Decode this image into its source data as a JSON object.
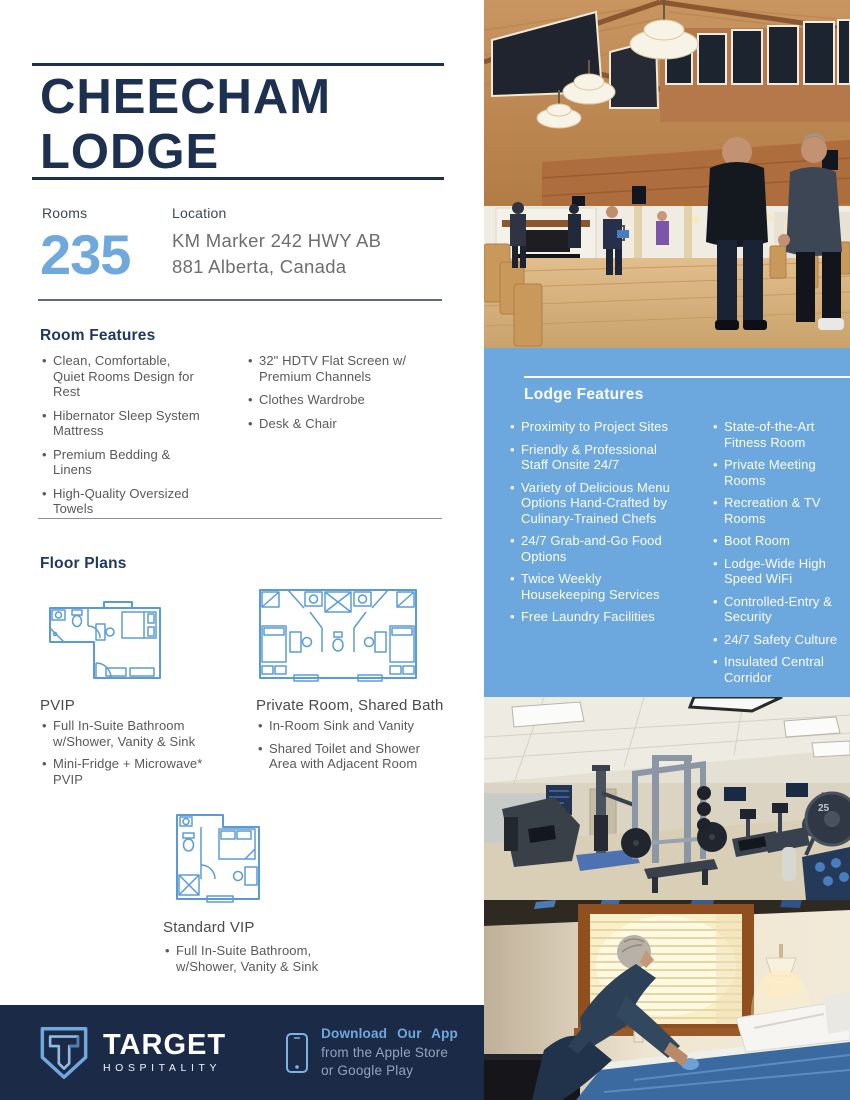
{
  "header": {
    "title_line1": "CHEECHAM",
    "title_line2": "LODGE"
  },
  "stats": {
    "rooms_label": "Rooms",
    "rooms_value": "235",
    "location_label": "Location",
    "location_line1": "KM Marker 242 HWY AB",
    "location_line2": "881 Alberta, Canada"
  },
  "room_features": {
    "heading": "Room Features",
    "col1": [
      "Clean, Comfortable, Quiet Rooms Design for Rest",
      "Hibernator Sleep System Mattress",
      "Premium Bedding & Linens",
      "High-Quality Oversized Towels"
    ],
    "col2": [
      "32\" HDTV Flat Screen w/ Premium Channels",
      "Clothes Wardrobe",
      "Desk & Chair"
    ]
  },
  "lodge_features": {
    "heading": "Lodge Features",
    "col1": [
      "Proximity to Project Sites",
      "Friendly & Professional Staff Onsite 24/7",
      "Variety of Delicious Menu Options Hand-Crafted by Culinary-Trained Chefs",
      "24/7 Grab-and-Go Food Options",
      "Twice Weekly Housekeeping Services",
      "Free Laundry Facilities"
    ],
    "col2": [
      "State-of-the-Art Fitness Room",
      "Private Meeting Rooms",
      "Recreation & TV Rooms",
      "Boot Room",
      "Lodge-Wide High Speed WiFi",
      "Controlled-Entry & Security",
      "24/7 Safety Culture",
      "Insulated Central Corridor"
    ]
  },
  "floor_plans": {
    "heading": "Floor Plans",
    "plans": [
      {
        "name": "PVIP",
        "bullets": [
          "Full In-Suite Bathroom w/Shower, Vanity & Sink",
          "Mini-Fridge + Microwave* PVIP"
        ]
      },
      {
        "name": "Private Room, Shared Bath",
        "bullets": [
          "In-Room Sink and Vanity",
          "Shared Toilet and Shower Area with Adjacent Room"
        ]
      },
      {
        "name": "Standard VIP",
        "bullets": [
          "Full In-Suite Bathroom, w/Shower, Vanity & Sink"
        ]
      }
    ]
  },
  "footer": {
    "brand_name": "TARGET",
    "brand_word": "HOSPITALITY",
    "download_line1": "Download Our App",
    "download_line2": "from the Apple Store",
    "download_line3": "or Google Play",
    "icons": [
      "target-shield-logo-icon",
      "phone-icon"
    ]
  },
  "photos": {
    "top": "lodge-interior-common-area",
    "middle": "fitness-room",
    "bottom": "housekeeping-bed-making",
    "gym_plate_label": "25"
  },
  "colors": {
    "navy_title": "#1E3050",
    "heading_navy": "#1F3864",
    "accent_blue": "#6FA8DC",
    "panel_blue": "#6CA7DD",
    "footer_navy": "#1B2A47",
    "body_gray": "#595959",
    "floorplan_stroke": "#5B9BD5"
  }
}
